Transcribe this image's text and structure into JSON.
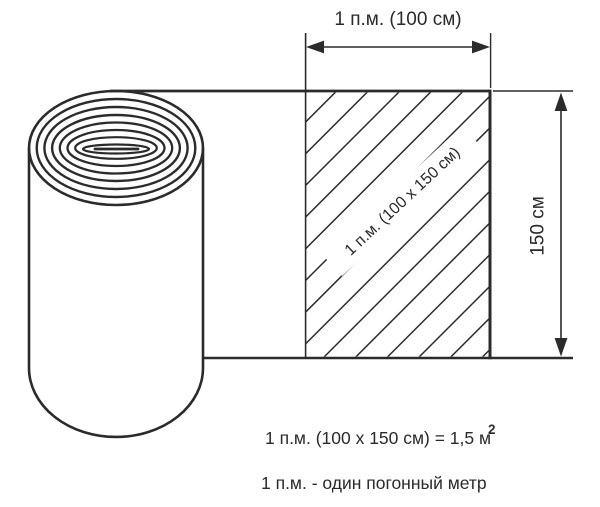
{
  "colors": {
    "line": "#2b2b2b",
    "text": "#2a2a2a",
    "background": "#ffffff"
  },
  "diagram": {
    "top_dimension": {
      "label": "1 п.м. (100 см)"
    },
    "right_dimension": {
      "label": "150 см"
    },
    "hatched_area": {
      "label": "1 п.м. (100 х 150 см)"
    },
    "notes": {
      "formula": "1 п.м. (100 х 150 см) = 1,5 м",
      "formula_superscript": "2",
      "definition": "1 п.м. - один погонный метр"
    }
  }
}
